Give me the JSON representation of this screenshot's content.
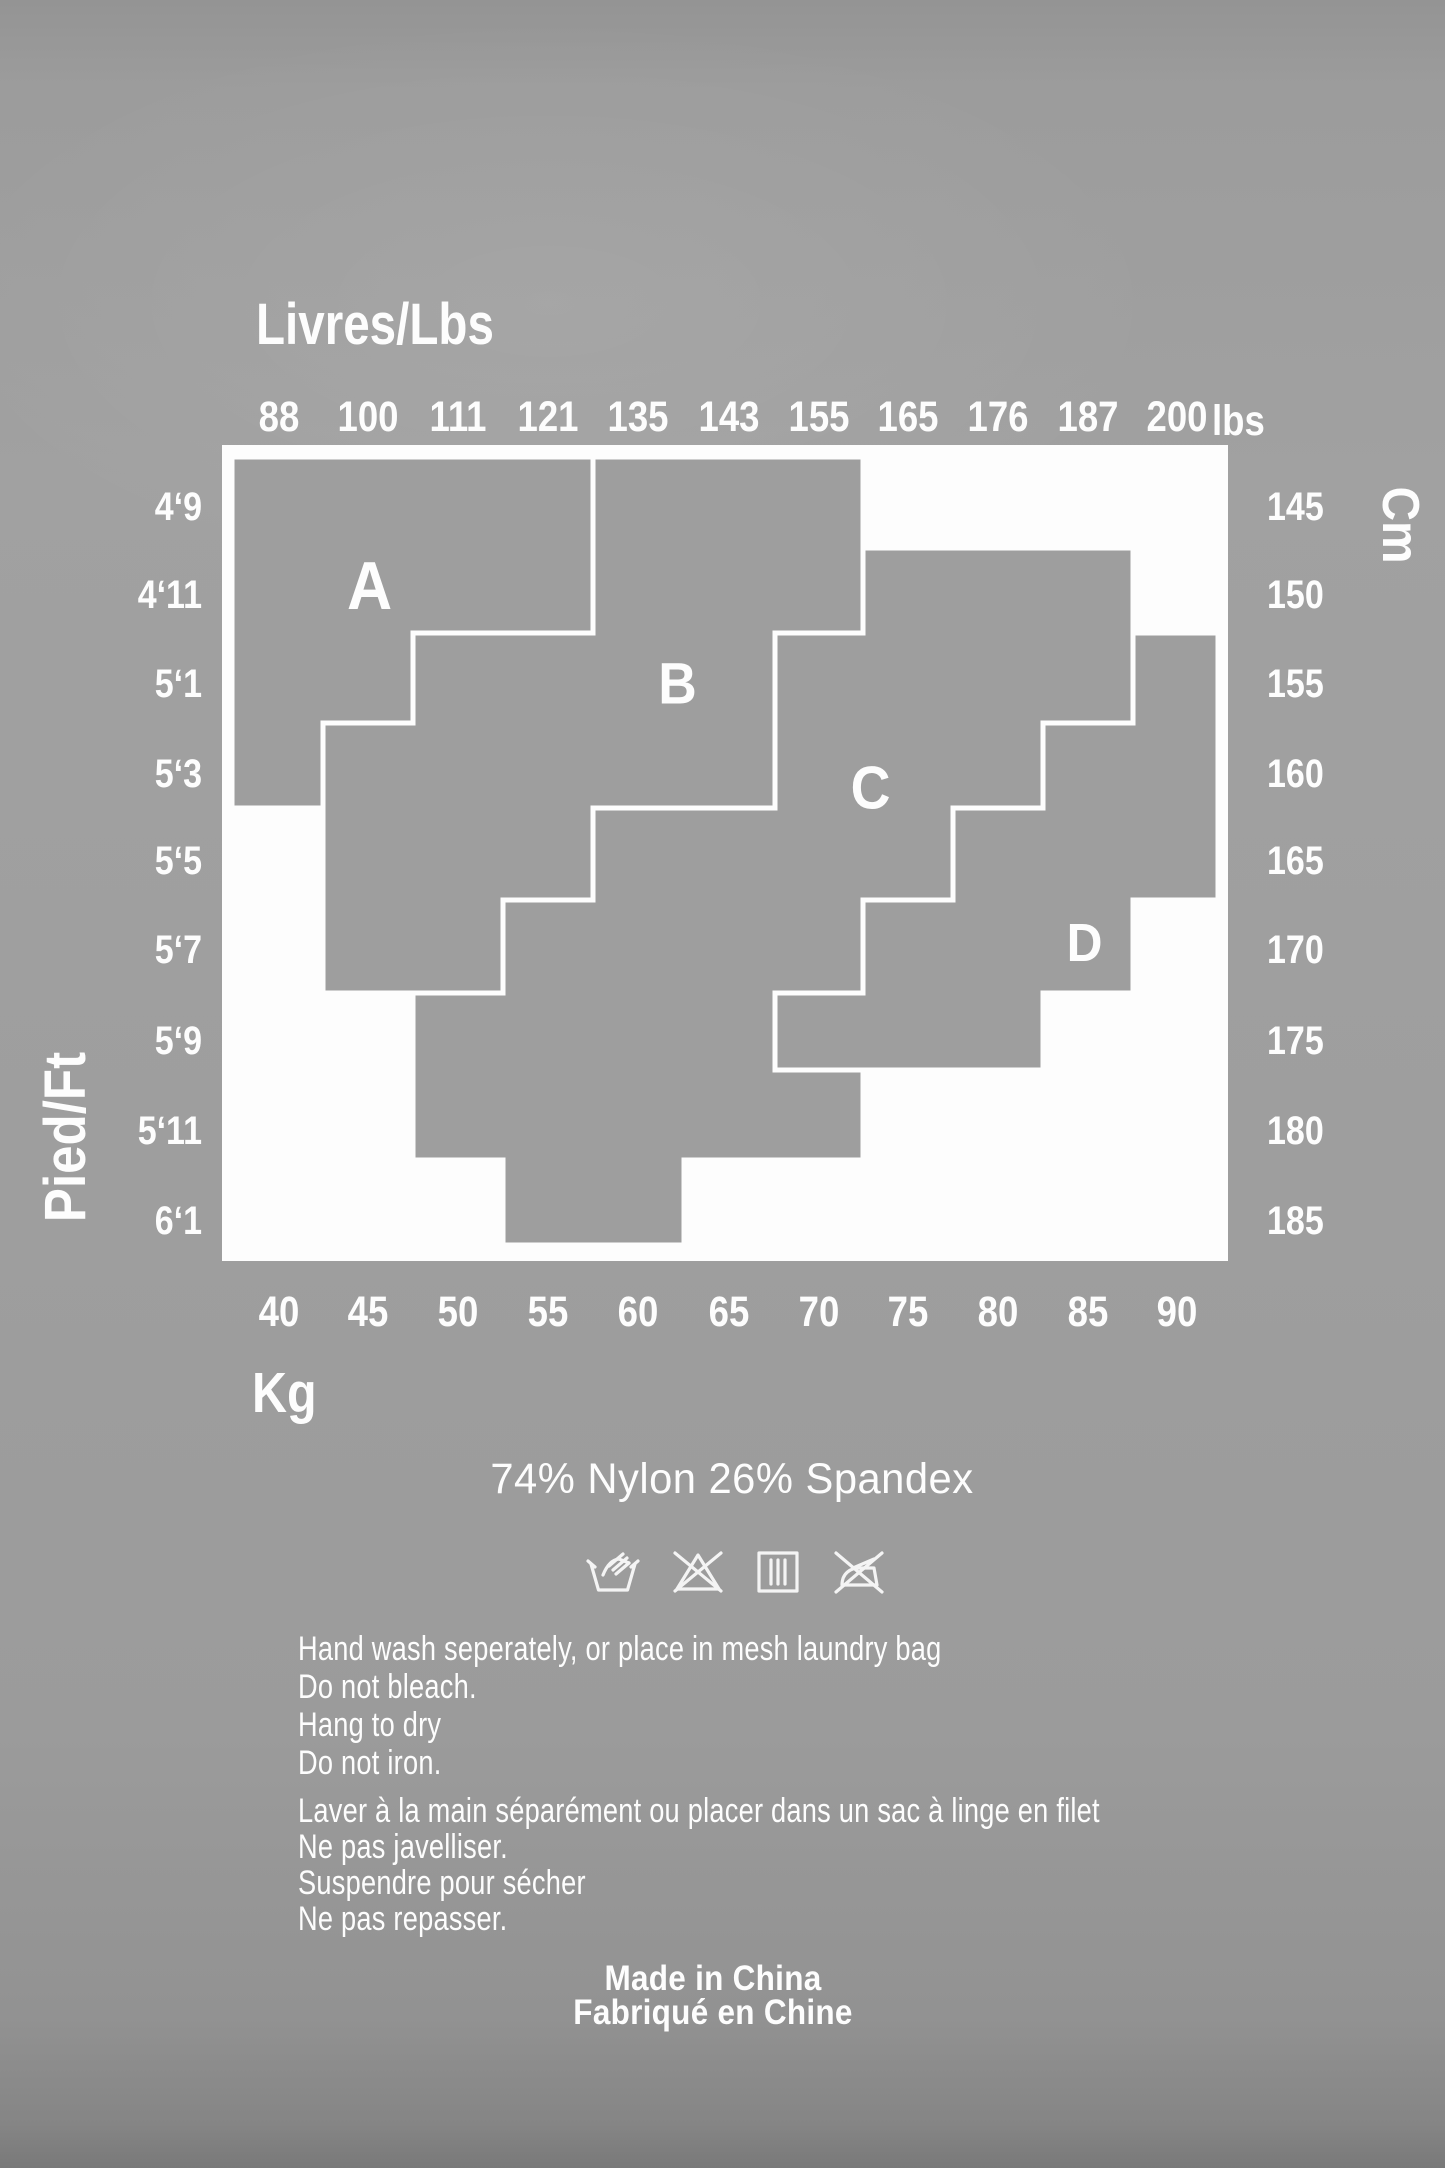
{
  "page": {
    "background": "#9e9e9e",
    "ink": "#fdfdfd",
    "kind": "garment size + care label"
  },
  "chart_data": {
    "type": "heatmap",
    "title": "Size zones A-D by weight (Livres/Lbs, Kg) and height (Pied/Ft, Cm)",
    "grid": "11 weight columns x 9 height rows",
    "x_top": {
      "label": "Livres/Lbs",
      "unit": "lbs",
      "ticks": [
        "88",
        "100",
        "111",
        "121",
        "135",
        "143",
        "155",
        "165",
        "176",
        "187",
        "200"
      ]
    },
    "x_bottom": {
      "label": "Kg",
      "ticks": [
        "40",
        "45",
        "50",
        "55",
        "60",
        "65",
        "70",
        "75",
        "80",
        "85",
        "90"
      ]
    },
    "y_left": {
      "label": "Pied/Ft",
      "ticks": [
        "4‘9",
        "4‘11",
        "5‘1",
        "5‘3",
        "5‘5",
        "5‘7",
        "5‘9",
        "5‘11",
        "6‘1"
      ]
    },
    "y_right": {
      "label": "Cm",
      "ticks": [
        "145",
        "150",
        "155",
        "160",
        "165",
        "170",
        "175",
        "180",
        "185"
      ]
    },
    "legend_position": "zone letters drawn inside zones",
    "regions": [
      {
        "label": "A",
        "cells_row_colspan": [
          [
            0,
            0,
            4
          ],
          [
            1,
            0,
            4
          ],
          [
            2,
            0,
            2
          ],
          [
            3,
            0,
            1
          ]
        ],
        "polygon": "232,457 593,457 593,633 413,633 413,723 323,723 323,808 232,808",
        "label_pos": [
          370,
          586
        ],
        "label_size": 68
      },
      {
        "label": "B",
        "cells_row_colspan": [
          [
            0,
            4,
            7
          ],
          [
            1,
            4,
            7
          ],
          [
            2,
            2,
            6
          ],
          [
            3,
            1,
            6
          ],
          [
            4,
            1,
            4
          ],
          [
            5,
            1,
            3
          ]
        ],
        "polygon": "593,457 863,457 863,633 775,633 775,808 593,808 593,900 503,900 503,993 323,993 323,723 413,723 413,633 593,633",
        "label_pos": [
          678,
          684
        ],
        "label_size": 58
      },
      {
        "label": "C",
        "cells_row_colspan": [
          [
            1,
            7,
            10
          ],
          [
            2,
            6,
            10
          ],
          [
            3,
            5,
            9
          ],
          [
            4,
            4,
            8
          ],
          [
            5,
            3,
            7
          ],
          [
            6,
            2,
            6
          ],
          [
            7,
            2,
            7
          ],
          [
            8,
            3,
            5
          ]
        ],
        "polygon": "863,548 1133,548 1133,723 1043,723 1043,808 953,808 953,900 863,900 863,993 775,993 775,1070 863,1070 863,1160 684,1160 684,1245 503,1245 503,1160 413,1160 413,993 503,993 503,900 593,900 593,808 775,808 775,633 863,633",
        "label_pos": [
          871,
          788
        ],
        "label_size": 60
      },
      {
        "label": "D",
        "cells_row_colspan": [
          [
            2,
            10,
            11
          ],
          [
            3,
            9,
            11
          ],
          [
            4,
            8,
            11
          ],
          [
            5,
            7,
            10
          ],
          [
            6,
            6,
            9
          ]
        ],
        "polygon": "1133,633 1218,633 1218,900 1133,900 1133,993 1043,993 1043,1070 775,1070 775,993 863,993 863,900 953,900 953,808 1043,808 1043,723 1133,723",
        "label_pos": [
          1085,
          943
        ],
        "label_size": 54
      }
    ],
    "layout": {
      "frame_px": [
        222,
        445,
        1006,
        816
      ],
      "grid_x_px": [
        232,
        323,
        413,
        503,
        593,
        684,
        775,
        863,
        953,
        1043,
        1133,
        1218
      ],
      "grid_y_px": [
        457,
        548,
        633,
        723,
        808,
        900,
        993,
        1070,
        1160,
        1245
      ],
      "col_centers_px": [
        279,
        368,
        458,
        548,
        638,
        729,
        819,
        908,
        998,
        1088,
        1177
      ],
      "row_centers_px": [
        507,
        595,
        684,
        774,
        861,
        950,
        1041,
        1131,
        1221
      ],
      "tick_rows_px": {
        "top": 396,
        "bottom": 1291
      }
    }
  },
  "care": {
    "composition": "74% Nylon 26% Spandex",
    "icons": [
      "hand-wash",
      "do-not-bleach",
      "drip-dry",
      "do-not-iron"
    ],
    "en": [
      "Hand wash seperately, or place in mesh laundry bag",
      "Do not bleach.",
      "Hang to dry",
      "Do not iron."
    ],
    "fr": [
      "Laver à la main séparément ou placer dans un sac à linge en filet",
      "Ne pas javelliser.",
      "Suspendre pour sécher",
      "Ne pas repasser."
    ],
    "origin": [
      "Made in China",
      "Fabriqué en Chine"
    ]
  }
}
